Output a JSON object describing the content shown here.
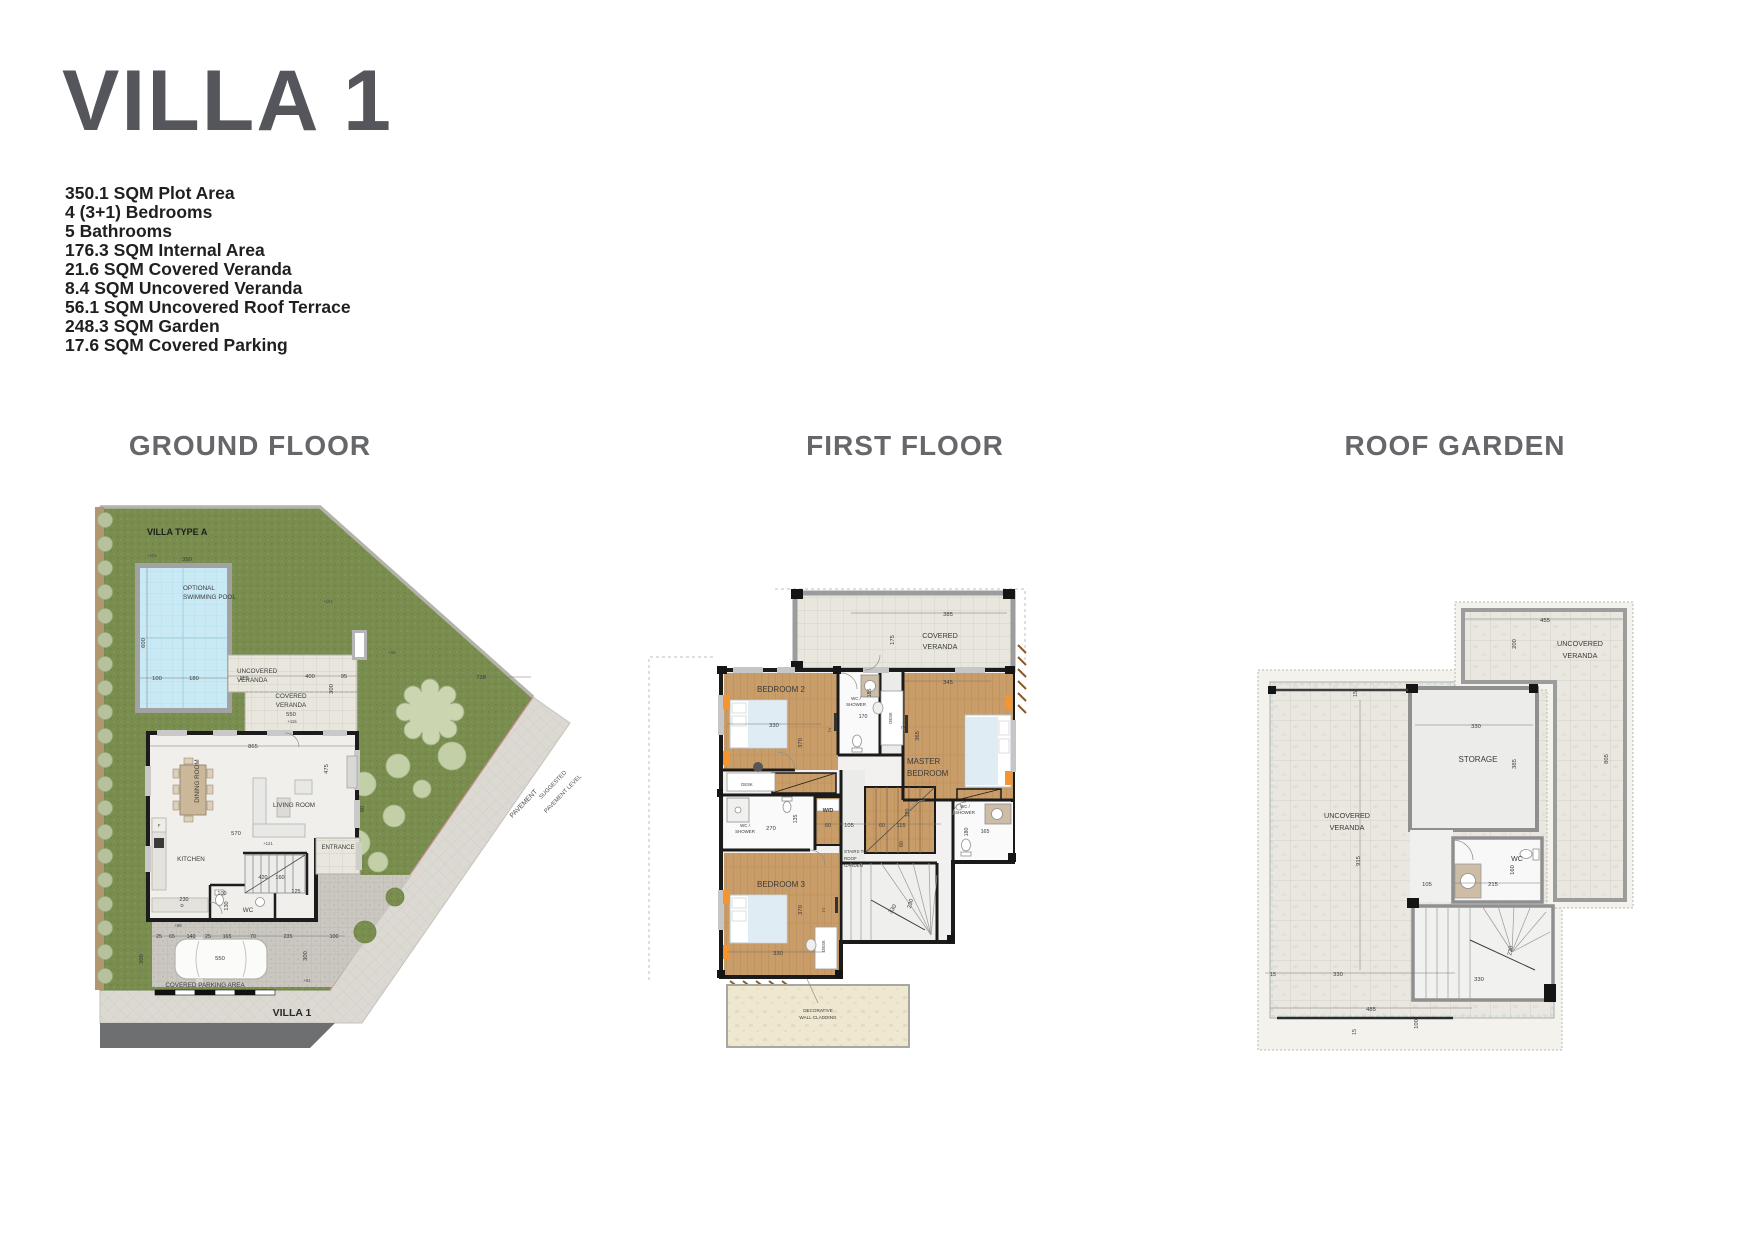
{
  "page": {
    "title": "VILLA 1"
  },
  "specs": [
    "350.1 SQM Plot Area",
    "4 (3+1) Bedrooms",
    "5 Bathrooms",
    "176.3 SQM Internal Area",
    "21.6 SQM Covered Veranda",
    "8.4 SQM Uncovered Veranda",
    "56.1 SQM Uncovered Roof Terrace",
    "248.3 SQM Garden",
    "17.6 SQM Covered Parking"
  ],
  "sections": [
    {
      "title": "GROUND FLOOR"
    },
    {
      "title": "FIRST FLOOR"
    },
    {
      "title": "ROOF GARDEN"
    }
  ],
  "plans": {
    "ground": {
      "name": "Ground floor plan",
      "labels": [
        {
          "t": "VILLA TYPE A",
          "x": 52,
          "y": 85,
          "s": 9,
          "w": "bold",
          "a": "start",
          "c": "#1d1d1d",
          "n": "label-villa-type-a"
        },
        {
          "t": "OPTIONAL",
          "x": 88,
          "y": 140,
          "s": 6.3,
          "a": "start",
          "n": "label-optional-pool-1"
        },
        {
          "t": "SWIMMING POOL",
          "x": 88,
          "y": 149,
          "s": 6.3,
          "a": "start",
          "n": "label-optional-pool-2"
        },
        {
          "t": "350",
          "x": 92,
          "y": 111,
          "s": 5.8
        },
        {
          "t": "600",
          "x": 50,
          "y": 193,
          "s": 5.8,
          "r": -90
        },
        {
          "t": "100",
          "x": 62,
          "y": 230,
          "s": 5.8
        },
        {
          "t": "180",
          "x": 99,
          "y": 230,
          "s": 5.8
        },
        {
          "t": "115",
          "x": 149,
          "y": 230,
          "s": 5.8
        },
        {
          "t": "UNCOVERED",
          "x": 142,
          "y": 223,
          "s": 6.3,
          "a": "start",
          "n": "label-uncovered-veranda-1"
        },
        {
          "t": "VERANDA",
          "x": 142,
          "y": 232,
          "s": 6.3,
          "a": "start",
          "n": "label-uncovered-veranda-2"
        },
        {
          "t": "400",
          "x": 215,
          "y": 228,
          "s": 5.8
        },
        {
          "t": "95",
          "x": 249,
          "y": 228,
          "s": 5.8
        },
        {
          "t": "COVERED",
          "x": 196,
          "y": 248,
          "s": 6.3,
          "n": "label-covered-veranda-1"
        },
        {
          "t": "VERANDA",
          "x": 196,
          "y": 257,
          "s": 6.3,
          "n": "label-covered-veranda-2"
        },
        {
          "t": "550",
          "x": 196,
          "y": 266,
          "s": 5.8
        },
        {
          "t": "300",
          "x": 238,
          "y": 239,
          "s": 5.8,
          "r": -90
        },
        {
          "t": "738",
          "x": 386,
          "y": 229,
          "s": 5.8
        },
        {
          "t": "865",
          "x": 158,
          "y": 298,
          "s": 5.8
        },
        {
          "t": "DINING ROOM",
          "x": 104,
          "y": 331,
          "s": 6.3,
          "r": -90,
          "n": "label-dining-room"
        },
        {
          "t": "LIVING ROOM",
          "x": 199,
          "y": 357,
          "s": 6.3,
          "n": "label-living-room"
        },
        {
          "t": "570",
          "x": 141,
          "y": 385,
          "s": 5.8
        },
        {
          "t": "475",
          "x": 233,
          "y": 319,
          "s": 5.8,
          "r": -90
        },
        {
          "t": "80",
          "x": 269,
          "y": 359,
          "s": 5.5,
          "r": -90
        },
        {
          "t": "KITCHEN",
          "x": 96,
          "y": 411,
          "s": 6.3,
          "n": "label-kitchen"
        },
        {
          "t": "ENTRANCE",
          "x": 243,
          "y": 399,
          "s": 6,
          "n": "label-entrance"
        },
        {
          "t": "420",
          "x": 168,
          "y": 429,
          "s": 5.5
        },
        {
          "t": "160",
          "x": 185,
          "y": 429,
          "s": 5.5
        },
        {
          "t": "100",
          "x": 127,
          "y": 445,
          "s": 5.5
        },
        {
          "t": "130",
          "x": 133,
          "y": 456,
          "s": 5.5,
          "r": -90
        },
        {
          "t": "WC",
          "x": 153,
          "y": 462,
          "s": 6.3,
          "n": "label-wc"
        },
        {
          "t": "125",
          "x": 201,
          "y": 443,
          "s": 5.5
        },
        {
          "t": "230",
          "x": 89,
          "y": 451,
          "s": 5.5
        },
        {
          "t": "25",
          "x": 64,
          "y": 488,
          "s": 5.3
        },
        {
          "t": "65",
          "x": 77,
          "y": 488,
          "s": 5.3
        },
        {
          "t": "140",
          "x": 96,
          "y": 488,
          "s": 5.3
        },
        {
          "t": "25",
          "x": 113,
          "y": 488,
          "s": 5.3
        },
        {
          "t": "165",
          "x": 132,
          "y": 488,
          "s": 5.3
        },
        {
          "t": "70",
          "x": 158,
          "y": 488,
          "s": 5.3
        },
        {
          "t": "235",
          "x": 193,
          "y": 488,
          "s": 5.3
        },
        {
          "t": "100",
          "x": 239,
          "y": 488,
          "s": 5.3
        },
        {
          "t": "550",
          "x": 125,
          "y": 510,
          "s": 5.8
        },
        {
          "t": "300",
          "x": 48,
          "y": 509,
          "s": 5.8,
          "r": -90
        },
        {
          "t": "300",
          "x": 212,
          "y": 506,
          "s": 5.8,
          "r": -90
        },
        {
          "t": "COVERED PARKING AREA",
          "x": 110,
          "y": 537,
          "s": 6.3,
          "n": "label-covered-parking-area"
        },
        {
          "t": "VILLA 1",
          "x": 197,
          "y": 566,
          "s": 10.5,
          "w": "bold",
          "c": "#2a2a2a",
          "n": "label-villa-1"
        },
        {
          "t": "PAVEMENT",
          "x": 430,
          "y": 355,
          "s": 6.8,
          "r": -46,
          "c": "#4c4c4c",
          "n": "label-pavement"
        },
        {
          "t": "SUGGESTED",
          "x": 459,
          "y": 336,
          "s": 5.8,
          "r": -46,
          "c": "#4c4c4c",
          "n": "label-suggested-pavement-1"
        },
        {
          "t": "PAVEMENT LEVEL",
          "x": 469,
          "y": 345,
          "s": 5.8,
          "r": -46,
          "c": "#4c4c4c",
          "n": "label-suggested-pavement-2"
        },
        {
          "t": "F",
          "x": 64,
          "y": 377,
          "s": 4.3
        },
        {
          "t": "D",
          "x": 87,
          "y": 457,
          "s": 4.3
        },
        {
          "t": "+101",
          "x": 57,
          "y": 107,
          "s": 4.3,
          "c": "#4c4c4c"
        },
        {
          "t": "+101",
          "x": 233,
          "y": 153,
          "s": 4.3,
          "c": "#4c4c4c"
        },
        {
          "t": "+95",
          "x": 297,
          "y": 204,
          "s": 4.3,
          "c": "#4c4c4c"
        },
        {
          "t": "+116",
          "x": 197,
          "y": 273,
          "s": 4.3,
          "c": "#4c4c4c"
        },
        {
          "t": "+121",
          "x": 173,
          "y": 395,
          "s": 4.3,
          "c": "#4c4c4c"
        },
        {
          "t": "+88",
          "x": 83,
          "y": 477,
          "s": 4.3,
          "c": "#4c4c4c"
        },
        {
          "t": "+91",
          "x": 212,
          "y": 532,
          "s": 4.3,
          "c": "#4c4c4c"
        }
      ]
    },
    "first": {
      "name": "First floor plan",
      "labels": [
        {
          "t": "COVERED",
          "x": 305,
          "y": 93,
          "s": 7.2,
          "n": "label-covered-veranda-1"
        },
        {
          "t": "VERANDA",
          "x": 305,
          "y": 104,
          "s": 7.2,
          "n": "label-covered-veranda-2"
        },
        {
          "t": "385",
          "x": 313,
          "y": 71,
          "s": 5.8
        },
        {
          "t": "175",
          "x": 259,
          "y": 95,
          "s": 5.8,
          "r": -90
        },
        {
          "t": "BEDROOM 2",
          "x": 146,
          "y": 147,
          "s": 8,
          "n": "label-bedroom-2"
        },
        {
          "t": "330",
          "x": 139,
          "y": 182,
          "s": 5.8
        },
        {
          "t": "370",
          "x": 167,
          "y": 198,
          "s": 5.8,
          "r": -90
        },
        {
          "t": "TV",
          "x": 196,
          "y": 185,
          "s": 3.8,
          "r": -90
        },
        {
          "t": "WC /",
          "x": 221,
          "y": 155,
          "s": 4.4
        },
        {
          "t": "SHOWER",
          "x": 221,
          "y": 161,
          "s": 4.4
        },
        {
          "t": "185",
          "x": 236,
          "y": 148,
          "s": 5.3,
          "r": -90
        },
        {
          "t": "170",
          "x": 228,
          "y": 173,
          "s": 5.3
        },
        {
          "t": "DESK",
          "x": 112,
          "y": 241,
          "s": 4.2
        },
        {
          "t": "DESK",
          "x": 257,
          "y": 173,
          "s": 4.2,
          "r": -90
        },
        {
          "t": "345",
          "x": 313,
          "y": 139,
          "s": 5.8
        },
        {
          "t": "MASTER",
          "x": 272,
          "y": 219,
          "s": 8,
          "a": "start",
          "n": "label-master-bedroom-1"
        },
        {
          "t": "BEDROOM",
          "x": 272,
          "y": 231,
          "s": 8,
          "a": "start",
          "n": "label-master-bedroom-2"
        },
        {
          "t": "365",
          "x": 284,
          "y": 191,
          "s": 5.8,
          "r": -90
        },
        {
          "t": "TV",
          "x": 268,
          "y": 184,
          "s": 3.8
        },
        {
          "t": "W/D",
          "x": 193,
          "y": 267,
          "s": 5.6,
          "w": "bold",
          "n": "label-wd"
        },
        {
          "t": "60",
          "x": 193,
          "y": 282,
          "s": 5.3
        },
        {
          "t": "105",
          "x": 214,
          "y": 282,
          "s": 5.8
        },
        {
          "t": "60",
          "x": 247,
          "y": 282,
          "s": 5.3
        },
        {
          "t": "115",
          "x": 266,
          "y": 282,
          "s": 5.8
        },
        {
          "t": "120",
          "x": 274,
          "y": 268,
          "s": 5.3,
          "r": -90
        },
        {
          "t": "60",
          "x": 268,
          "y": 299,
          "s": 5.3,
          "r": -90
        },
        {
          "t": "STAIRS TO",
          "x": 209,
          "y": 308,
          "s": 4.4,
          "a": "start",
          "n": "label-stairs-to-roof-1"
        },
        {
          "t": "ROOF",
          "x": 209,
          "y": 315,
          "s": 4.4,
          "a": "start",
          "n": "label-stairs-to-roof-2"
        },
        {
          "t": "GARDEN",
          "x": 209,
          "y": 322,
          "s": 4.4,
          "a": "start",
          "n": "label-stairs-to-roof-3"
        },
        {
          "t": "330",
          "x": 259,
          "y": 365,
          "s": 5.8,
          "r": -55
        },
        {
          "t": "230",
          "x": 277,
          "y": 359,
          "s": 5.8,
          "r": -75
        },
        {
          "t": "WC /",
          "x": 110,
          "y": 282,
          "s": 4.4
        },
        {
          "t": "SHOWER",
          "x": 110,
          "y": 288,
          "s": 4.4
        },
        {
          "t": "270",
          "x": 136,
          "y": 285,
          "s": 5.8
        },
        {
          "t": "135",
          "x": 162,
          "y": 274,
          "s": 5.3,
          "r": -90
        },
        {
          "t": "BEDROOM 3",
          "x": 146,
          "y": 342,
          "s": 8,
          "n": "label-bedroom-3"
        },
        {
          "t": "370",
          "x": 167,
          "y": 365,
          "s": 5.8,
          "r": -90
        },
        {
          "t": "TV",
          "x": 190,
          "y": 365,
          "s": 3.8,
          "r": -90
        },
        {
          "t": "330",
          "x": 143,
          "y": 410,
          "s": 5.8
        },
        {
          "t": "DESK",
          "x": 190,
          "y": 401,
          "s": 4.2,
          "r": -90
        },
        {
          "t": "WC /",
          "x": 330,
          "y": 263,
          "s": 4.4
        },
        {
          "t": "SHOWER",
          "x": 330,
          "y": 269,
          "s": 4.4
        },
        {
          "t": "180",
          "x": 333,
          "y": 287,
          "s": 5.3,
          "r": -90
        },
        {
          "t": "165",
          "x": 350,
          "y": 288,
          "s": 5.3
        },
        {
          "t": "DECORATIVE",
          "x": 183,
          "y": 467,
          "s": 4.6,
          "n": "label-decorative-cladding-1"
        },
        {
          "t": "WALL CLADDING",
          "x": 183,
          "y": 474,
          "s": 4.6,
          "n": "label-decorative-cladding-2"
        }
      ]
    },
    "roof": {
      "name": "Roof garden plan",
      "labels": [
        {
          "t": "455",
          "x": 295,
          "y": 82,
          "s": 5.8
        },
        {
          "t": "UNCOVERED",
          "x": 330,
          "y": 106,
          "s": 7.2,
          "n": "label-uncovered-veranda-right-1"
        },
        {
          "t": "VERANDA",
          "x": 330,
          "y": 118,
          "s": 7.2,
          "n": "label-uncovered-veranda-right-2"
        },
        {
          "t": "200",
          "x": 266,
          "y": 104,
          "s": 5.8,
          "r": -90
        },
        {
          "t": "805",
          "x": 358,
          "y": 219,
          "s": 5.8,
          "r": -90
        },
        {
          "t": "15",
          "x": 107,
          "y": 154,
          "s": 5.3,
          "r": -90
        },
        {
          "t": "330",
          "x": 226,
          "y": 188,
          "s": 5.8
        },
        {
          "t": "STORAGE",
          "x": 228,
          "y": 222,
          "s": 8,
          "n": "label-storage"
        },
        {
          "t": "385",
          "x": 266,
          "y": 224,
          "s": 5.8,
          "r": -90
        },
        {
          "t": "UNCOVERED",
          "x": 97,
          "y": 278,
          "s": 7.2,
          "n": "label-uncovered-veranda-left-1"
        },
        {
          "t": "VERANDA",
          "x": 97,
          "y": 290,
          "s": 7.2,
          "n": "label-uncovered-veranda-left-2"
        },
        {
          "t": "915",
          "x": 110,
          "y": 321,
          "s": 5.8,
          "r": -90
        },
        {
          "t": "105",
          "x": 177,
          "y": 346,
          "s": 5.8
        },
        {
          "t": "WC",
          "x": 267,
          "y": 321,
          "s": 7,
          "n": "label-wc"
        },
        {
          "t": "215",
          "x": 243,
          "y": 346,
          "s": 5.8
        },
        {
          "t": "160",
          "x": 264,
          "y": 330,
          "s": 5.8,
          "r": -90
        },
        {
          "t": "230",
          "x": 262,
          "y": 411,
          "s": 5.8,
          "r": -80
        },
        {
          "t": "330",
          "x": 229,
          "y": 441,
          "s": 5.8
        },
        {
          "t": "15",
          "x": 23,
          "y": 436,
          "s": 5.3
        },
        {
          "t": "330",
          "x": 88,
          "y": 436,
          "s": 5.8
        },
        {
          "t": "485",
          "x": 121,
          "y": 471,
          "s": 5.8
        },
        {
          "t": "15",
          "x": 106,
          "y": 492,
          "s": 5.3,
          "r": -90
        },
        {
          "t": "100",
          "x": 168,
          "y": 484,
          "s": 5.8,
          "r": -90
        }
      ]
    }
  }
}
